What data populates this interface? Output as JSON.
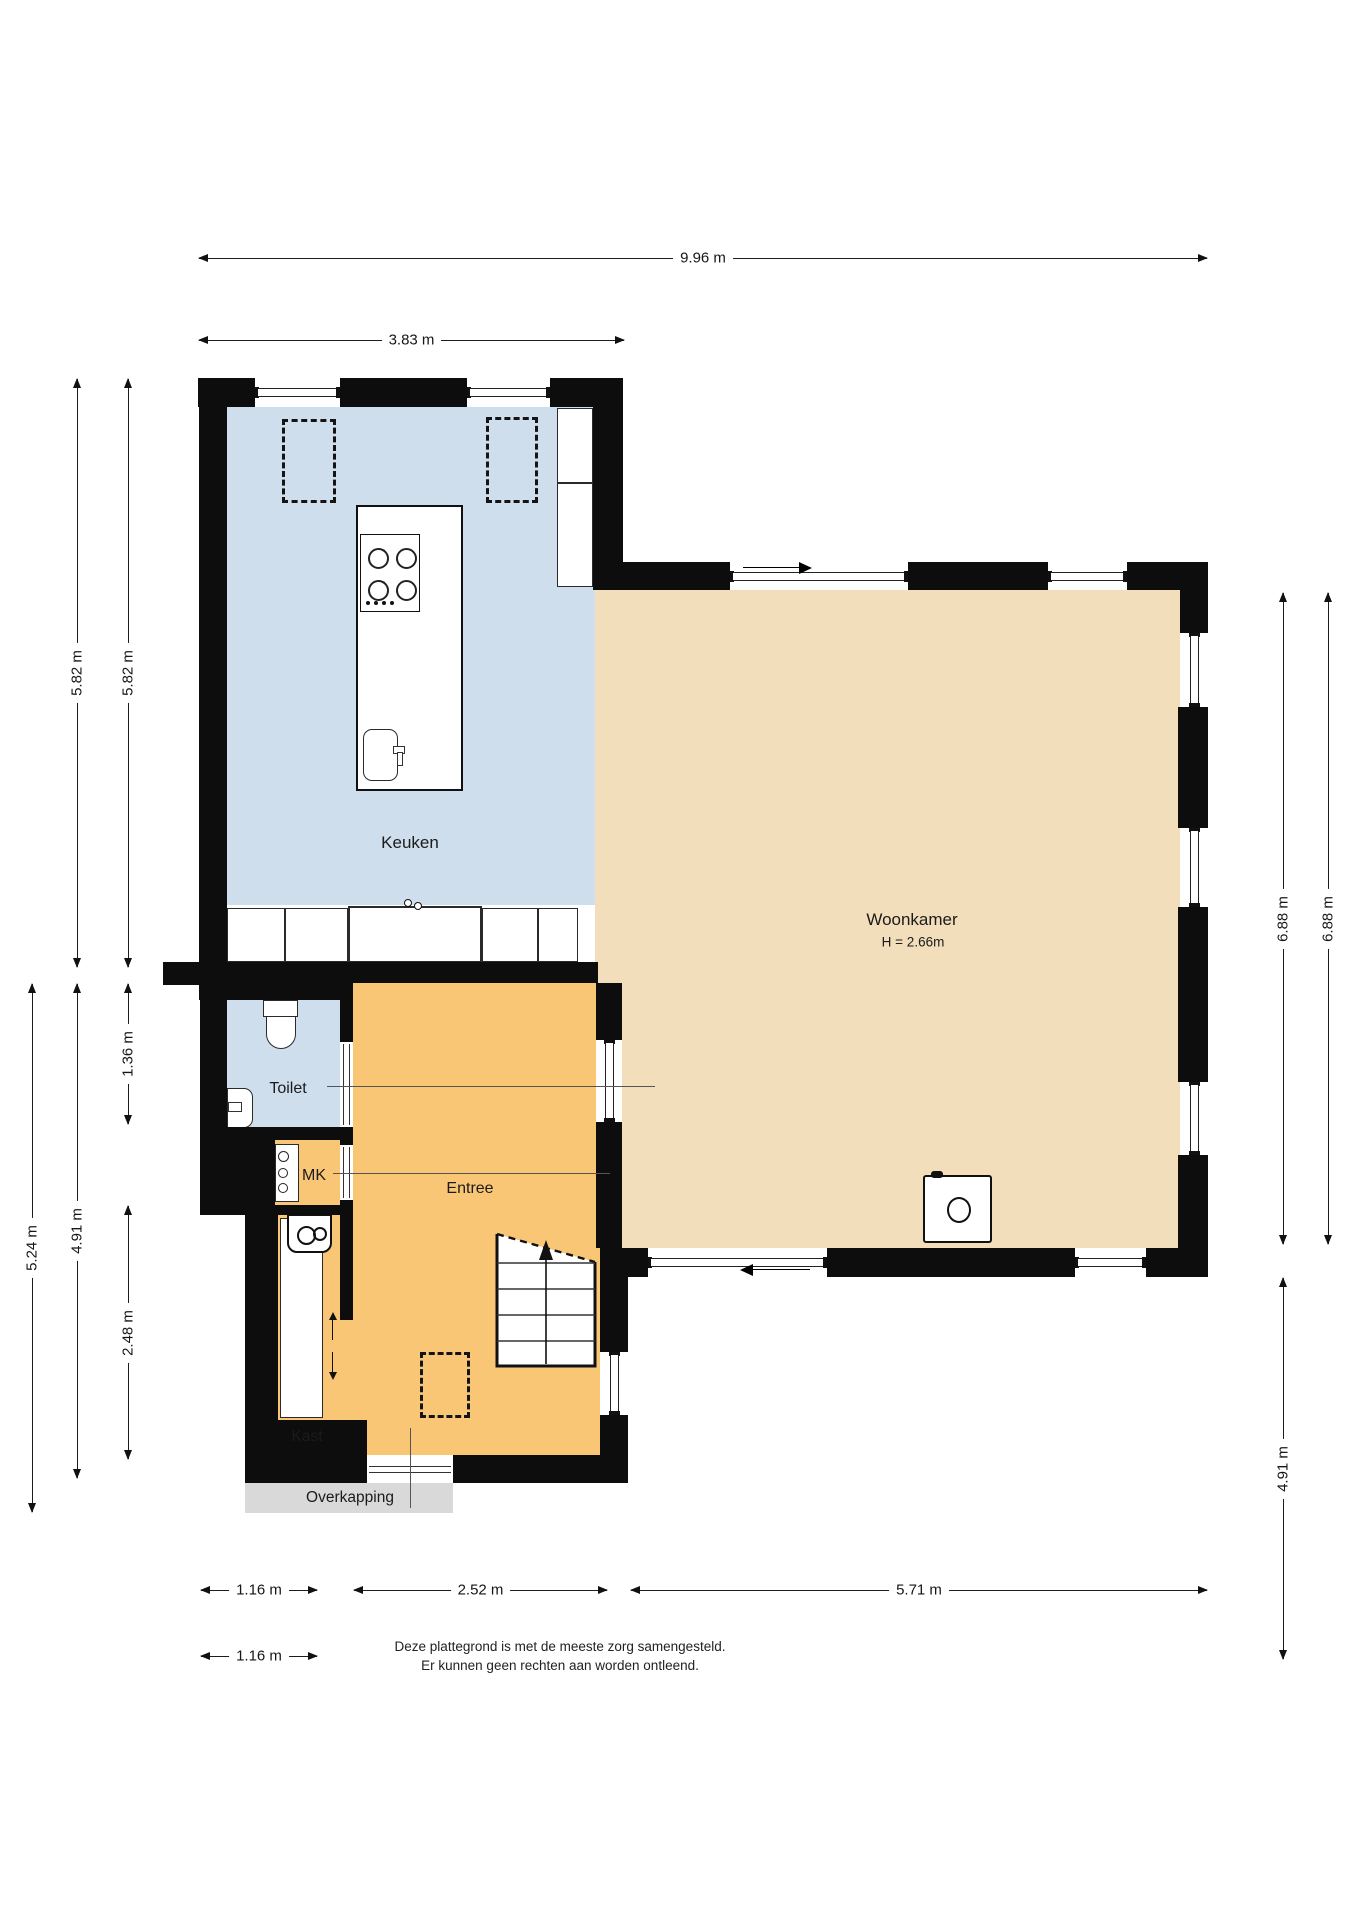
{
  "plan": {
    "type": "floorplan-ground-floor",
    "language": "nl"
  },
  "rooms": {
    "keuken": {
      "label": "Keuken"
    },
    "woonkamer": {
      "label": "Woonkamer",
      "ceiling_height": "H = 2.66m"
    },
    "toilet": {
      "label": "Toilet"
    },
    "mk": {
      "label": "MK"
    },
    "entree": {
      "label": "Entree"
    },
    "kast": {
      "label": "Kast"
    },
    "overkapping": {
      "label": "Overkapping"
    }
  },
  "dimensions": {
    "top_total": "9.96 m",
    "top_kitchen": "3.83 m",
    "left_kitchen_outer": "5.82 m",
    "left_kitchen_inner": "5.82 m",
    "left_toilet": "1.36 m",
    "left_block_outer": "5.24 m",
    "left_block_inner": "4.91 m",
    "left_kast": "2.48 m",
    "right_living_outer": "6.88 m",
    "right_living_inner": "6.88 m",
    "right_lower": "4.91 m",
    "bottom_kast": "1.16 m",
    "bottom_entree": "2.52 m",
    "bottom_living": "5.71 m",
    "bottom_kast_2": "1.16 m"
  },
  "footer": {
    "line1": "Deze plattegrond is met de meeste zorg samengesteld.",
    "line2": "Er kunnen geen rechten aan worden ontleend."
  },
  "colors": {
    "wall": "#0d0d0d",
    "floor_keuken": "#cfdeed",
    "floor_toilet": "#cfdeed",
    "floor_woonkamer": "#f2deba",
    "floor_entree": "#f9c676",
    "overkapping": "#d9d9d9"
  }
}
